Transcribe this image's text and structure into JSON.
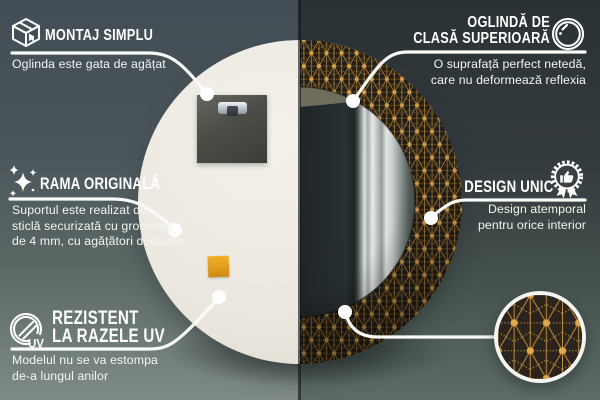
{
  "palette": {
    "wall_left_top": "#424d55",
    "wall_left_bottom": "#7f8b86",
    "wall_right_top": "#2b3236",
    "wall_right_bottom": "#5e6c67",
    "mirror_back": "#ece8e0",
    "frame_pattern_background": "#262019",
    "frame_pattern_gold": "#cf9c42",
    "callout_line_white": "#fafaf8",
    "sticker_orange": "#e19c1d"
  },
  "callouts": {
    "montaj": {
      "icon": "box-icon",
      "title": "MONTAJ SIMPLU",
      "desc": "Oglinda este gata de agățat"
    },
    "rama": {
      "icon": "sparkles-icon",
      "title": "RAMA ORIGINALĂ",
      "desc": "Suportul este realizat din\nsticlă securizată cu grosimea\nde 4 mm, cu agățători dedicate"
    },
    "rezistent": {
      "icon": "uv-circle-icon",
      "title": "REZISTENT\nLA RAZELE UV",
      "desc": "Modelul nu se va estompa\nde-a lungul anilor",
      "icon_label": "UV"
    },
    "oglinda": {
      "icon": "mirror-circle-icon",
      "title": "OGLINDĂ DE\nCLASĂ SUPERIOARĂ",
      "desc": "O suprafață perfect netedă,\ncare nu deformează reflexia"
    },
    "design": {
      "icon": "award-badge-icon",
      "title": "DESIGN UNIC",
      "desc": "Design atemporal\npentru orice interior"
    }
  }
}
